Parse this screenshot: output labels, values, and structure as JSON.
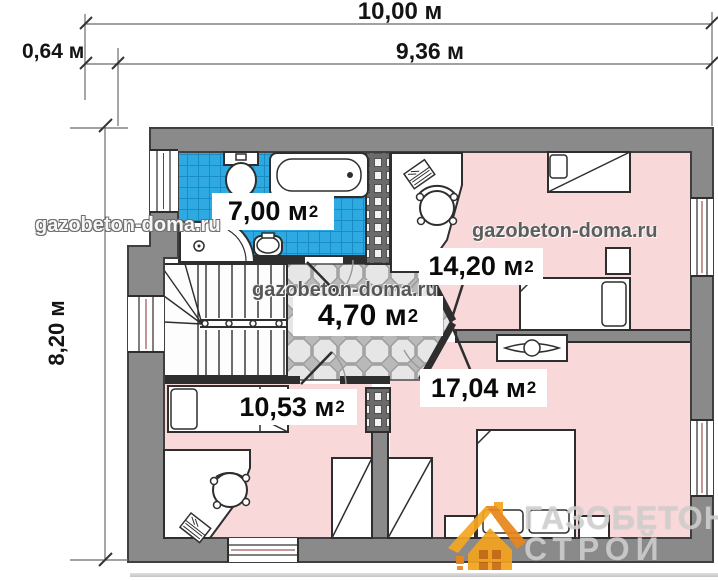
{
  "dimensions": {
    "total_width": "10,00 м",
    "inner_width": "9,36 м",
    "left_offset": "0,64 м",
    "height": "8,20 м"
  },
  "rooms": {
    "bathroom": {
      "area": "7,00 м",
      "sup": "2"
    },
    "bedroom_top_right": {
      "area": "14,20 м",
      "sup": "2"
    },
    "hallway": {
      "area": "4,70 м",
      "sup": "2"
    },
    "bedroom_bottom_left": {
      "area": "10,53 м",
      "sup": "2"
    },
    "bedroom_bottom_right": {
      "area": "17,04 м",
      "sup": "2"
    }
  },
  "watermarks": {
    "site": "gazobeton-doma.ru"
  },
  "logo": {
    "line1": "ГАЗОБЕТОН",
    "line2": "СТРОЙ"
  },
  "colors": {
    "room_pink": "#f8d8d8",
    "tile_blue": "#2fa9e1",
    "wall_gray": "#8a8a8a",
    "logo_orange": "#f2a31f"
  }
}
